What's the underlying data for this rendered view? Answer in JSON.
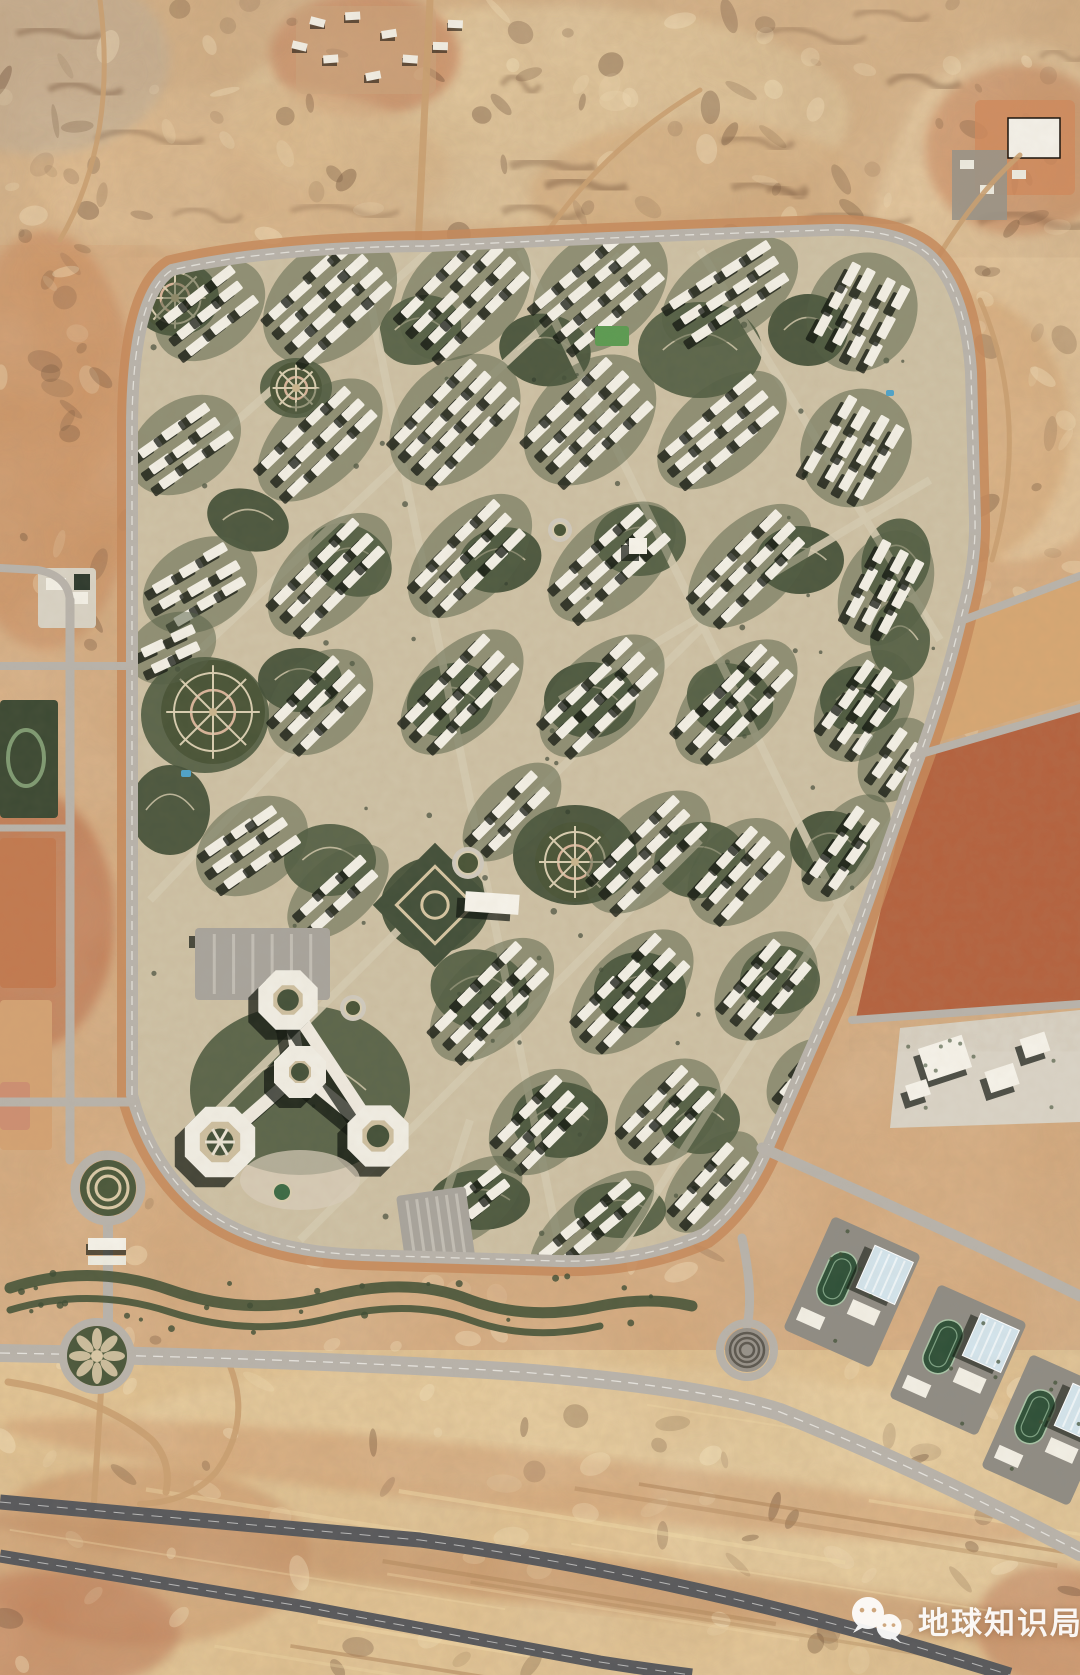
{
  "canvas": {
    "w": 1080,
    "h": 1675
  },
  "scene": {
    "kind": "satellite-photo",
    "subject": "desert new-town residential compound with ring road, surrounding highways, school campuses and vacant plots",
    "palette": {
      "desert_base": "#d7aa7d",
      "desert_sand": "#e7c997",
      "desert_red": "#c1734b",
      "road_light": "#b8b3ab",
      "asphalt": "#58595c",
      "ring_median": "#c58a5c",
      "building_white": "#f2efe5",
      "shadow": "#10160f",
      "park_green": "#46523a",
      "park_green2": "#556147",
      "path_tan": "#d8cdb0",
      "track_green": "#2f5139",
      "roof_blue": "#d3e4ec",
      "plot_red": "#b4613e",
      "pool_blue": "#4fa3c9"
    }
  },
  "watermark": {
    "text": "地球知识局",
    "icon": "wechat-logo",
    "color": "#ffffff"
  },
  "layers": {
    "patches": [
      [
        "r",
        0,
        0,
        1080,
        245,
        "#d8b286",
        1,
        0
      ],
      [
        "r",
        0,
        1350,
        1080,
        325,
        "#e4c491",
        1,
        0
      ],
      [
        "e",
        540,
        115,
        310,
        110,
        "#e9d0a2",
        0.75,
        0
      ],
      [
        "e",
        1015,
        300,
        150,
        260,
        "#e6c79b",
        0.9,
        0
      ],
      [
        "e",
        45,
        440,
        95,
        210,
        "#cd8f60",
        0.85,
        0
      ],
      [
        "e",
        30,
        920,
        85,
        130,
        "#c0734c",
        0.95,
        0
      ],
      [
        "e",
        365,
        55,
        95,
        62,
        "#c87f57",
        0.8,
        0
      ],
      [
        "e",
        1020,
        150,
        95,
        85,
        "#c97f52",
        0.7,
        0
      ],
      [
        "e",
        140,
        1555,
        170,
        90,
        "#cf9a6b",
        0.8,
        0
      ],
      [
        "e",
        880,
        1510,
        230,
        120,
        "#e9cd9d",
        0.9,
        0
      ],
      [
        "e",
        540,
        1425,
        420,
        60,
        "#ecd2a2",
        0.7,
        0
      ],
      [
        "e",
        55,
        1630,
        125,
        60,
        "#b96a46",
        0.6,
        0
      ],
      [
        "e",
        1050,
        1625,
        75,
        60,
        "#b96a46",
        0.55,
        0
      ],
      [
        "e",
        240,
        170,
        210,
        85,
        "#e2bd8e",
        0.7,
        0
      ],
      [
        "e",
        700,
        195,
        170,
        75,
        "#d9ad7c",
        0.7,
        0
      ],
      [
        "e",
        40,
        60,
        130,
        95,
        "#bcae9a",
        0.6,
        0
      ],
      [
        "e",
        950,
        430,
        120,
        140,
        "#d9ab79",
        0.8,
        0
      ],
      [
        "e",
        540,
        1578,
        560,
        26,
        "#b97a50",
        0.5,
        6
      ],
      [
        "e",
        520,
        1480,
        520,
        30,
        "#c98a5e",
        0.45,
        6
      ]
    ],
    "east_plots": [
      {
        "pts": "952,630 1080,575 1080,700 918,748",
        "f": "#d8a873"
      },
      {
        "pts": "916,756 1080,706 1080,1004 856,1018",
        "f": "#b4613e"
      },
      {
        "pts": "900,1028 1080,1010 1080,1122 890,1128",
        "f": "#d9d3c6"
      }
    ],
    "left_plots": [
      [
        38,
        568,
        58,
        60,
        "#d8d2c4"
      ],
      [
        0,
        700,
        58,
        118,
        "#3d4a34"
      ],
      [
        0,
        838,
        56,
        150,
        "#c27a50"
      ],
      [
        0,
        1000,
        52,
        150,
        "#d3a273"
      ],
      [
        0,
        1082,
        30,
        48,
        "#cd8f72"
      ]
    ],
    "roads_light": [
      {
        "d": "M70 600 L70 1160",
        "w": 9
      },
      {
        "d": "M70 604 Q70 576 38 570 L0 568",
        "w": 8
      },
      {
        "d": "M0 666 L132 666",
        "w": 8
      },
      {
        "d": "M0 828 L70 828",
        "w": 7
      },
      {
        "d": "M0 1102 L132 1102",
        "w": 9
      },
      {
        "d": "M108 1156 L108 1360",
        "w": 10
      },
      {
        "d": "M0 1353 Q300 1358 520 1372 Q700 1386 780 1412 Q920 1468 1080 1552",
        "w": 18,
        "dash": true
      },
      {
        "d": "M762 1148 Q880 1200 990 1252 L1080 1296",
        "w": 11
      },
      {
        "d": "M958 622 L1080 576",
        "w": 8
      },
      {
        "d": "M914 756 L1080 708",
        "w": 8
      },
      {
        "d": "M852 1020 L1080 1004",
        "w": 8
      },
      {
        "d": "M742 1238 Q754 1294 747 1326",
        "w": 9
      }
    ],
    "roads_dirt": [
      {
        "d": "M418 247 L430 0",
        "w": 7
      },
      {
        "d": "M540 243 Q600 150 700 90",
        "w": 5
      },
      {
        "d": "M935 262 Q975 195 1020 155",
        "w": 5
      },
      {
        "d": "M60 240 Q118 140 100 0",
        "w": 5
      },
      {
        "d": "M8 1382 Q100 1396 152 1440 Q172 1462 166 1492",
        "w": 7
      },
      {
        "d": "M230 1366 Q252 1422 216 1472 Q190 1502 140 1504",
        "w": 6
      },
      {
        "d": "M103 1360 L94 1502",
        "w": 6
      },
      {
        "d": "M980 300 Q1032 420 992 560",
        "w": 5
      }
    ],
    "roads_dark": [
      {
        "d": "M0 1502 L420 1540 Q700 1578 1010 1675",
        "w": 15
      },
      {
        "d": "M0 1556 L300 1606 Q480 1640 600 1662 Q652 1670 692 1675",
        "w": 13
      }
    ],
    "compound": {
      "outline": "M132 1095 L132 430 Q132 295 172 270 Q270 247 430 246 Q640 236 828 230 Q908 228 936 262 Q966 298 971 372 L975 520 Q976 562 962 614 Q944 692 910 782 L836 992 L770 1142 Q746 1202 704 1234 Q638 1263 558 1261 L362 1255 Q252 1251 196 1203 Q150 1162 132 1095 Z",
      "base": "#cfc3a7"
    },
    "streets": [
      "M360 250 L560 1250",
      "M208 1120 L790 540",
      "M200 650 L620 255",
      "M520 250 L880 990",
      "M700 250 L940 640",
      "M300 1240 L700 840",
      "M620 1250 L905 800",
      "M170 480 L430 250",
      "M560 700 L930 480",
      "M150 900 L360 680",
      "M428 1250 L470 1120"
    ],
    "parks": [
      [
        205,
        715,
        64,
        58,
        0
      ],
      [
        175,
        298,
        44,
        38,
        0
      ],
      [
        296,
        388,
        36,
        30,
        0
      ],
      [
        248,
        520,
        42,
        30,
        20
      ],
      [
        420,
        330,
        42,
        34,
        -20
      ],
      [
        545,
        350,
        46,
        36,
        10
      ],
      [
        700,
        350,
        62,
        48,
        0
      ],
      [
        808,
        330,
        40,
        36,
        0
      ],
      [
        350,
        560,
        44,
        34,
        30
      ],
      [
        500,
        560,
        42,
        32,
        -15
      ],
      [
        640,
        540,
        46,
        36,
        0
      ],
      [
        800,
        560,
        44,
        34,
        0
      ],
      [
        896,
        560,
        34,
        42,
        15
      ],
      [
        300,
        680,
        42,
        32,
        0
      ],
      [
        450,
        700,
        44,
        36,
        -20
      ],
      [
        590,
        700,
        46,
        38,
        0
      ],
      [
        730,
        700,
        44,
        36,
        20
      ],
      [
        860,
        700,
        40,
        34,
        0
      ],
      [
        330,
        860,
        46,
        36,
        0
      ],
      [
        575,
        855,
        62,
        50,
        0
      ],
      [
        700,
        860,
        46,
        38,
        -10
      ],
      [
        830,
        845,
        40,
        34,
        0
      ],
      [
        480,
        990,
        50,
        40,
        15
      ],
      [
        640,
        990,
        46,
        38,
        0
      ],
      [
        780,
        980,
        40,
        34,
        0
      ],
      [
        560,
        1120,
        48,
        38,
        0
      ],
      [
        700,
        1120,
        40,
        34,
        0
      ],
      [
        435,
        905,
        54,
        48,
        0
      ],
      [
        300,
        1090,
        110,
        85,
        0
      ],
      [
        480,
        1200,
        50,
        30,
        0
      ],
      [
        620,
        1210,
        46,
        28,
        0
      ],
      [
        170,
        810,
        40,
        45,
        0
      ],
      [
        900,
        640,
        30,
        40,
        0
      ]
    ],
    "clusters": [
      [
        210,
        310,
        -38,
        3,
        3
      ],
      [
        330,
        300,
        -42,
        4,
        4
      ],
      [
        465,
        295,
        -45,
        4,
        4
      ],
      [
        600,
        290,
        -40,
        4,
        4
      ],
      [
        730,
        292,
        -33,
        3,
        4
      ],
      [
        862,
        312,
        -62,
        4,
        3
      ],
      [
        185,
        445,
        -35,
        3,
        3
      ],
      [
        320,
        440,
        -44,
        3,
        4
      ],
      [
        455,
        420,
        -46,
        4,
        4
      ],
      [
        590,
        420,
        -44,
        4,
        4
      ],
      [
        722,
        430,
        -40,
        3,
        4
      ],
      [
        856,
        448,
        -60,
        4,
        3
      ],
      [
        200,
        585,
        -30,
        3,
        3
      ],
      [
        330,
        575,
        -45,
        3,
        4
      ],
      [
        470,
        556,
        -45,
        3,
        4
      ],
      [
        612,
        562,
        -42,
        3,
        4
      ],
      [
        750,
        566,
        -45,
        3,
        4
      ],
      [
        886,
        588,
        -62,
        3,
        3
      ],
      [
        320,
        702,
        -45,
        3,
        3
      ],
      [
        462,
        692,
        -46,
        3,
        4
      ],
      [
        602,
        696,
        -44,
        3,
        4
      ],
      [
        736,
        702,
        -46,
        3,
        4
      ],
      [
        864,
        706,
        -55,
        3,
        3
      ],
      [
        252,
        846,
        -35,
        3,
        3
      ],
      [
        338,
        892,
        -42,
        2,
        3
      ],
      [
        512,
        812,
        -45,
        2,
        3
      ],
      [
        648,
        852,
        -44,
        3,
        4
      ],
      [
        740,
        872,
        -48,
        3,
        3
      ],
      [
        846,
        848,
        -55,
        2,
        3
      ],
      [
        492,
        1000,
        -45,
        3,
        4
      ],
      [
        632,
        992,
        -46,
        3,
        4
      ],
      [
        766,
        986,
        -50,
        3,
        3
      ],
      [
        542,
        1122,
        -45,
        3,
        3
      ],
      [
        668,
        1112,
        -46,
        3,
        3
      ],
      [
        592,
        1226,
        -40,
        2,
        4
      ],
      [
        470,
        1202,
        -38,
        2,
        3
      ],
      [
        712,
        1182,
        -48,
        2,
        3
      ],
      [
        172,
        648,
        -25,
        2,
        2
      ],
      [
        896,
        760,
        -55,
        2,
        2
      ],
      [
        806,
        1080,
        -50,
        2,
        2
      ]
    ],
    "circ_gardens": [
      [
        175,
        298,
        34
      ],
      [
        213,
        712,
        52
      ],
      [
        296,
        388,
        26
      ],
      [
        575,
        862,
        40
      ]
    ],
    "diamond_garden": [
      435,
      905,
      44
    ],
    "mini_roundabouts": [
      [
        468,
        863,
        11
      ],
      [
        353,
        1008,
        8
      ],
      [
        560,
        530,
        7
      ]
    ],
    "white_buildings": [
      [
        492,
        903,
        54,
        20,
        4
      ],
      [
        638,
        546,
        18,
        16,
        0
      ],
      [
        205,
        935,
        16,
        12,
        0
      ]
    ],
    "green_field": [
      612,
      336,
      34,
      20
    ],
    "pools": [
      [
        181,
        770,
        10,
        7
      ],
      [
        886,
        390,
        8,
        6
      ]
    ],
    "sw_complex": {
      "octs": [
        [
          288,
          1000,
          24
        ],
        [
          300,
          1072,
          20
        ],
        [
          220,
          1142,
          30
        ],
        [
          378,
          1136,
          25
        ]
      ],
      "wings": [
        [
          288,
          1000,
          300,
          1072
        ],
        [
          300,
          1072,
          220,
          1142
        ],
        [
          300,
          1072,
          378,
          1136
        ],
        [
          288,
          1000,
          378,
          1136
        ]
      ],
      "combs": [
        [
          195,
          928,
          135,
          72,
          0
        ],
        [
          396,
          1196,
          70,
          84,
          -8
        ]
      ],
      "plaza": [
        300,
        1180,
        60,
        30
      ],
      "pond": [
        282,
        1192,
        9
      ]
    },
    "campuses": [
      [
        852,
        1292,
        24
      ],
      [
        958,
        1360,
        24
      ],
      [
        1050,
        1430,
        24
      ]
    ],
    "mosque_bldgs": [
      [
        945,
        1058,
        46,
        34,
        -18
      ],
      [
        1002,
        1078,
        30,
        22,
        -18
      ],
      [
        1035,
        1045,
        26,
        20,
        -18
      ],
      [
        918,
        1090,
        22,
        16,
        -18
      ]
    ],
    "roundabouts": {
      "entry": [
        108,
        1188
      ],
      "flower": [
        97,
        1356
      ],
      "spiral": [
        747,
        1350
      ]
    },
    "greenway": [
      {
        "d": "M10 1288 Q90 1262 170 1290 Q250 1318 330 1296 Q410 1276 470 1300 Q530 1322 600 1306 Q650 1296 692 1306",
        "w": 11
      },
      {
        "d": "M10 1310 Q90 1286 170 1312 Q250 1338 330 1318 Q410 1298 470 1320 Q530 1342 600 1326",
        "w": 7
      }
    ],
    "camp_whites": [
      [
        318,
        18
      ],
      [
        352,
        12
      ],
      [
        388,
        30
      ],
      [
        330,
        55
      ],
      [
        300,
        42
      ],
      [
        410,
        55
      ],
      [
        372,
        72
      ],
      [
        440,
        42
      ],
      [
        455,
        20
      ]
    ],
    "topright": {
      "ground": [
        975,
        100,
        100,
        95
      ],
      "big": [
        1008,
        118,
        52,
        40
      ],
      "gray": [
        952,
        150,
        55,
        70
      ],
      "small": [
        [
          960,
          160
        ],
        [
          980,
          185
        ],
        [
          1012,
          170
        ]
      ]
    },
    "speckle_bands": [
      {
        "x": 0,
        "y": 0,
        "w": 1080,
        "h": 240,
        "n": 95
      },
      {
        "x": 0,
        "y": 240,
        "w": 125,
        "h": 420,
        "n": 24
      },
      {
        "x": 935,
        "y": 240,
        "w": 145,
        "h": 430,
        "n": 30
      },
      {
        "x": 0,
        "y": 1360,
        "w": 1080,
        "h": 310,
        "n": 70
      },
      {
        "x": 860,
        "y": 600,
        "w": 220,
        "h": 430,
        "n": 24
      },
      {
        "x": 120,
        "y": 1160,
        "w": 600,
        "h": 190,
        "n": 26
      }
    ],
    "streaks": {
      "x": 0,
      "y": 1390,
      "w": 1080,
      "h": 270,
      "n": 14,
      "slope": 0.16
    },
    "ridges": {
      "x": 0,
      "y": 10,
      "w": 1080,
      "h": 215,
      "n": 18
    },
    "trees": {
      "n": 90,
      "x": 140,
      "y": 250,
      "w": 810,
      "h": 1000
    }
  }
}
